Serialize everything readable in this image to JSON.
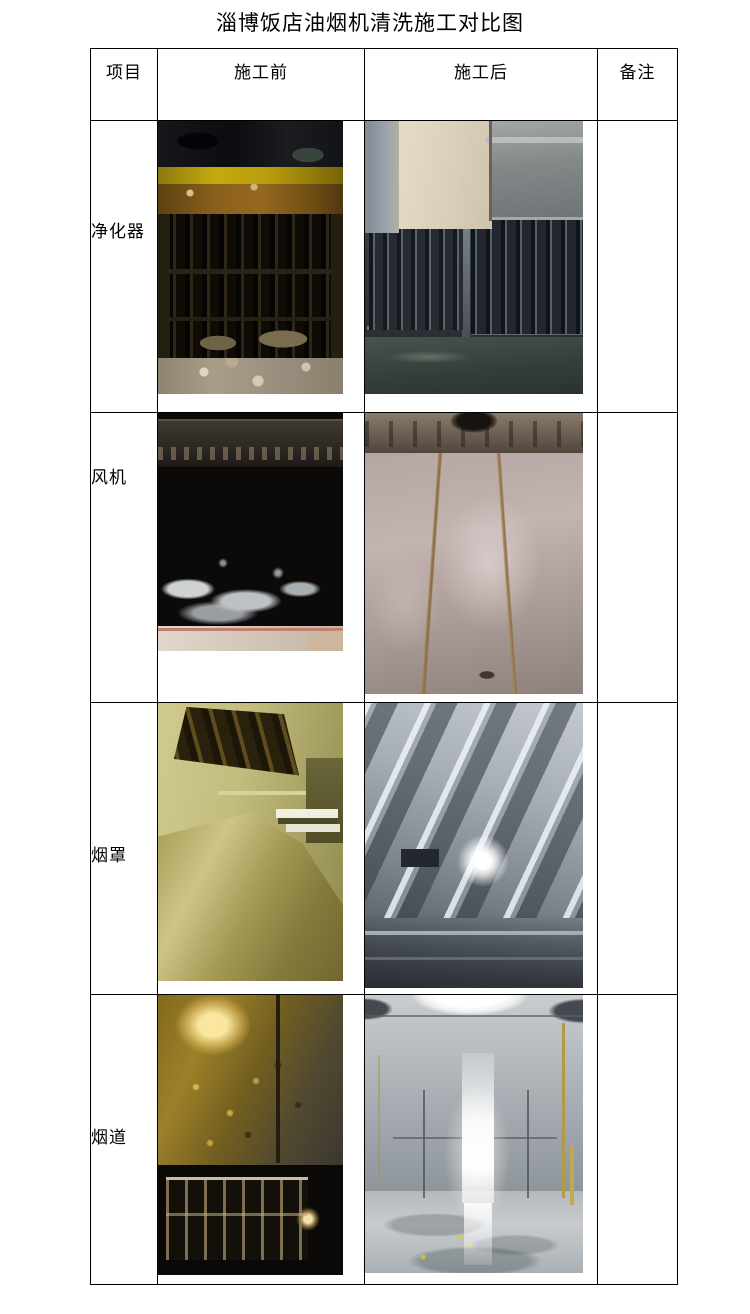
{
  "page": {
    "title": "淄博饭店油烟机清洗施工对比图"
  },
  "table": {
    "headers": {
      "item": "项目",
      "before": "施工前",
      "after": "施工后",
      "remark": "备注"
    },
    "rows": [
      {
        "label": "净化器",
        "remark": ""
      },
      {
        "label": "风机",
        "remark": ""
      },
      {
        "label": "烟罩",
        "remark": ""
      },
      {
        "label": "烟道",
        "remark": ""
      }
    ]
  }
}
